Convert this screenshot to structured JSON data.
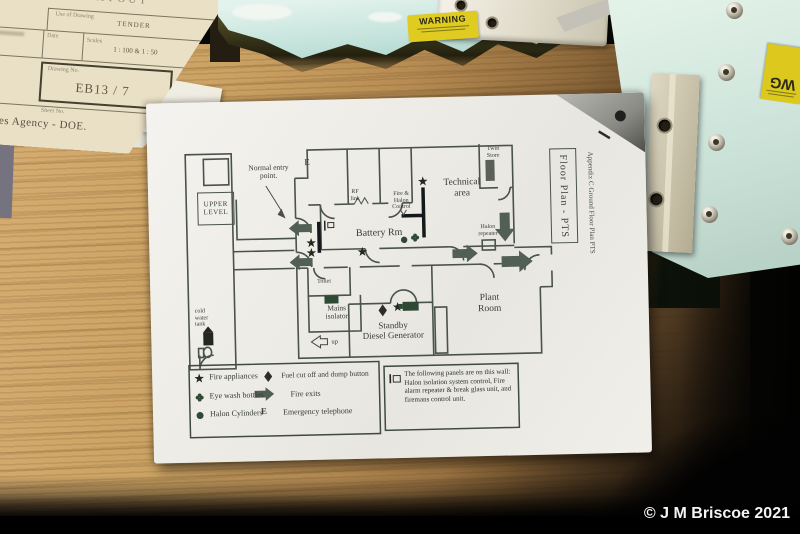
{
  "scene": {
    "copyright": "© J M Briscoe 2021"
  },
  "form": {
    "title": "LAYOUT",
    "use_label": "Use of Drawing",
    "use_value": "TENDER",
    "date_label": "Date",
    "scales_label": "Scales",
    "scales_value": "1 : 100   &   1 : 50",
    "drawing_no_label": "Drawing No.",
    "drawing_no_value": "EB13 / 7",
    "sheet_label": "Sheet No.",
    "agency": "vices Agency - DOE."
  },
  "stickers": {
    "warning": "WARNING",
    "right_fragment": "WG"
  },
  "plan": {
    "title_box": "Floor Plan - PTS",
    "appendix": "Appendix C Ground Floor Plan PTS",
    "annotations": {
      "normal_entry": "Normal entry\npoint.",
      "e": "E",
      "rf_link": "RF\nlink",
      "fire_halon": "Fire &\nHalon\nControl",
      "technical": "Technical\narea",
      "twin_store": "Twin\nStore",
      "battery": "Battery Rm",
      "halon_repeater": "Halon\nrepeater",
      "upper_level": "UPPER\nLEVEL",
      "cold_water": "cold\nwater\ntank",
      "toilet": "Toilet",
      "mains": "Mains\nisolator",
      "standby": "Standby\nDiesel Generator",
      "plant": "Plant\nRoom",
      "up": "up"
    },
    "legend": {
      "col1": [
        {
          "icon": "star-icon",
          "label": "Fire appliances"
        },
        {
          "icon": "clover-icon",
          "label": "Eye wash bottles"
        },
        {
          "icon": "circle-icon",
          "label": "Halon Cylinders"
        }
      ],
      "col2": [
        {
          "icon": "diamond-icon",
          "label": "Fuel cut off and dump button"
        },
        {
          "icon": "arrow-icon",
          "label": "Fire exits"
        },
        {
          "icon": "E",
          "label": "Emergency telephone"
        }
      ],
      "panel_note": "The following panels are on this wall: Halon isolation system control, Fire alarm repeater & break glass unit, and firemans control unit."
    }
  },
  "colors": {
    "plan_ink": "#49524b",
    "symbol_green": "#2e4a35",
    "arrow_green": "#515f54",
    "panel_blue": "#c9e5de",
    "sticker_yellow": "#e0cb20",
    "wood_light": "#d6ad72",
    "paper_white": "#efeeea",
    "form_cream": "#eae0c6"
  }
}
